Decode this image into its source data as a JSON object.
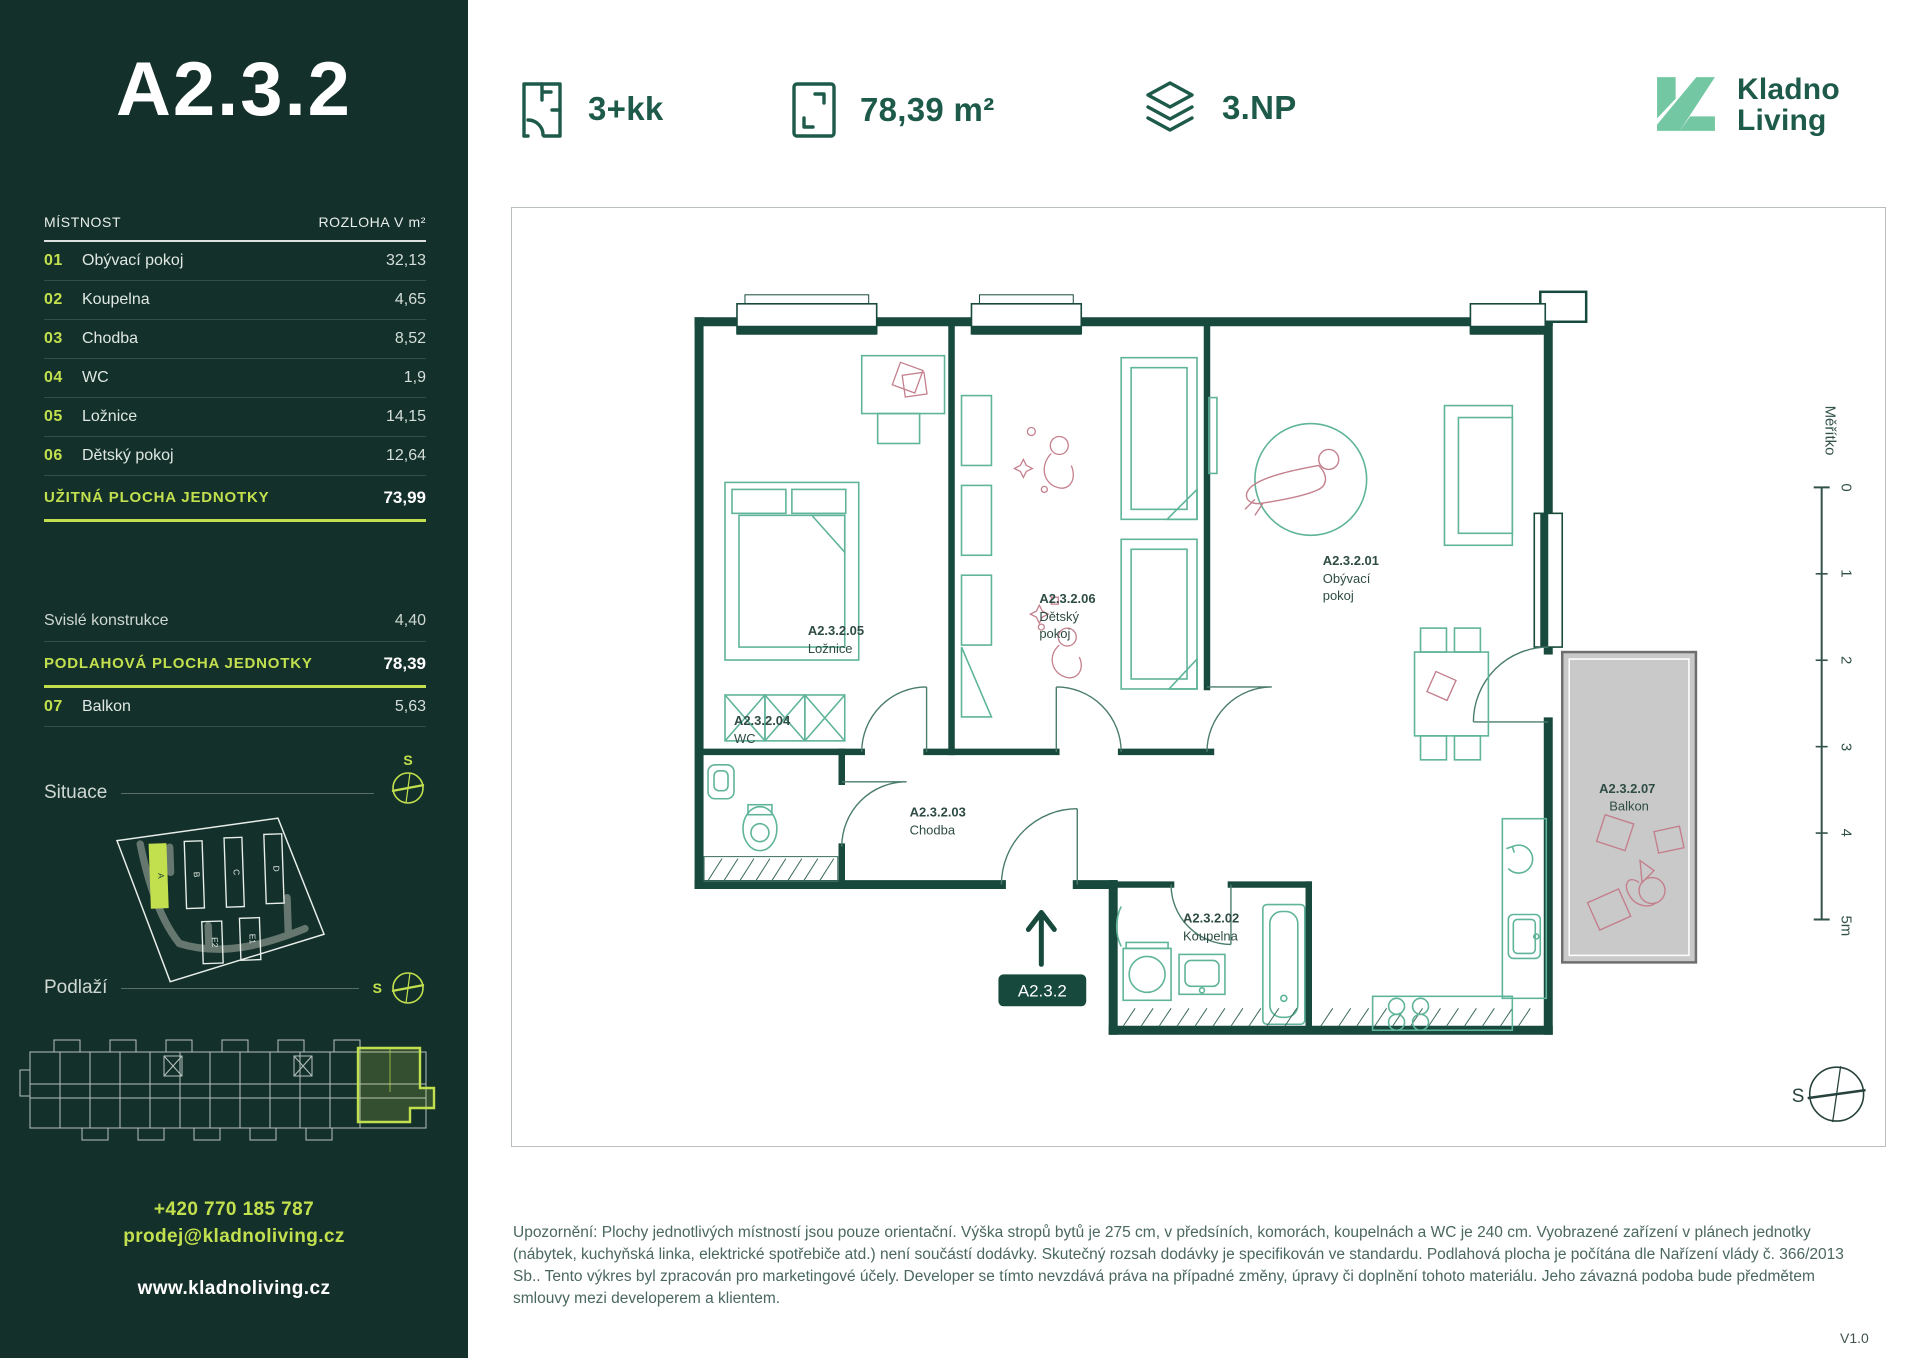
{
  "unit": {
    "title": "A2.3.2",
    "layout": "3+kk",
    "area": "78,39 m²",
    "floor": "3.NP",
    "badge": "A2.3.2",
    "version": "V1.0"
  },
  "brand": {
    "line1": "Kladno",
    "line2": "Living"
  },
  "room_table": {
    "col_room": "MÍSTNOST",
    "col_area": "ROZLOHA V m²",
    "rows": [
      {
        "num": "01",
        "name": "Obývací pokoj",
        "area": "32,13"
      },
      {
        "num": "02",
        "name": "Koupelna",
        "area": "4,65"
      },
      {
        "num": "03",
        "name": "Chodba",
        "area": "8,52"
      },
      {
        "num": "04",
        "name": "WC",
        "area": "1,9"
      },
      {
        "num": "05",
        "name": "Ložnice",
        "area": "14,15"
      },
      {
        "num": "06",
        "name": "Dětský pokoj",
        "area": "12,64"
      }
    ],
    "usable": {
      "label": "UŽITNÁ PLOCHA JEDNOTKY",
      "value": "73,99"
    },
    "vertical": {
      "label": "Svislé konstrukce",
      "value": "4,40"
    },
    "floor_area": {
      "label": "PODLAHOVÁ PLOCHA JEDNOTKY",
      "value": "78,39"
    },
    "balcony": {
      "num": "07",
      "name": "Balkon",
      "area": "5,63"
    }
  },
  "situace": {
    "label": "Situace",
    "compass": "S",
    "buildings": [
      "A",
      "B",
      "C",
      "D",
      "E2",
      "E1"
    ]
  },
  "podlazi": {
    "label": "Podlaží",
    "compass": "S"
  },
  "contact": {
    "phone": "+420 770 185 787",
    "email": "prodej@kladnoliving.cz",
    "web": "www.kladnoliving.cz"
  },
  "plan": {
    "compass": "S",
    "scale": {
      "label": "Měřítko",
      "ticks": [
        "0",
        "1",
        "2",
        "3",
        "4",
        "5m"
      ]
    },
    "labels": {
      "obyvaci": {
        "code": "A2.3.2.01",
        "l1": "Obývací",
        "l2": "pokoj"
      },
      "koupelna": {
        "code": "A2.3.2.02",
        "l1": "Koupelna"
      },
      "chodba": {
        "code": "A2.3.2.03",
        "l1": "Chodba"
      },
      "wc": {
        "code": "A2.3.2.04",
        "l1": "WC"
      },
      "loznice": {
        "code": "A2.3.2.05",
        "l1": "Ložnice"
      },
      "detsky": {
        "code": "A2.3.2.06",
        "l1": "Dětský",
        "l2": "pokoj"
      },
      "balkon": {
        "code": "A2.3.2.07",
        "l1": "Balkon"
      }
    }
  },
  "disclaimer": "Upozornění: Plochy jednotlivých místností jsou pouze orientační. Výška stropů bytů je 275 cm, v předsíních, komorách, koupelnách a WC je 240 cm. Vyobrazené zařízení v plánech jednotky (nábytek, kuchyňská linka, elektrické spotřebiče atd.) není součástí dodávky. Skutečný rozsah dodávky je specifikován ve standardu. Podlahová plocha je počítána dle Nařízení vlády č. 366/2013 Sb.. Tento výkres byl zpracován pro marketingové účely. Developer se tímto nevzdává práva na případné změny, úpravy či doplnění tohoto materiálu. Jeho závazná podoba bude předmětem smlouvy mezi developerem a klientem.",
  "colors": {
    "sidebar_bg": "#14302a",
    "accent_lime": "#c2e04e",
    "dark_green": "#1d5a4a",
    "mint": "#74c7a3",
    "furniture_teal": "#5fb49a",
    "figure_pink": "#c4808d",
    "balcony_gray": "#c9c9c9"
  }
}
